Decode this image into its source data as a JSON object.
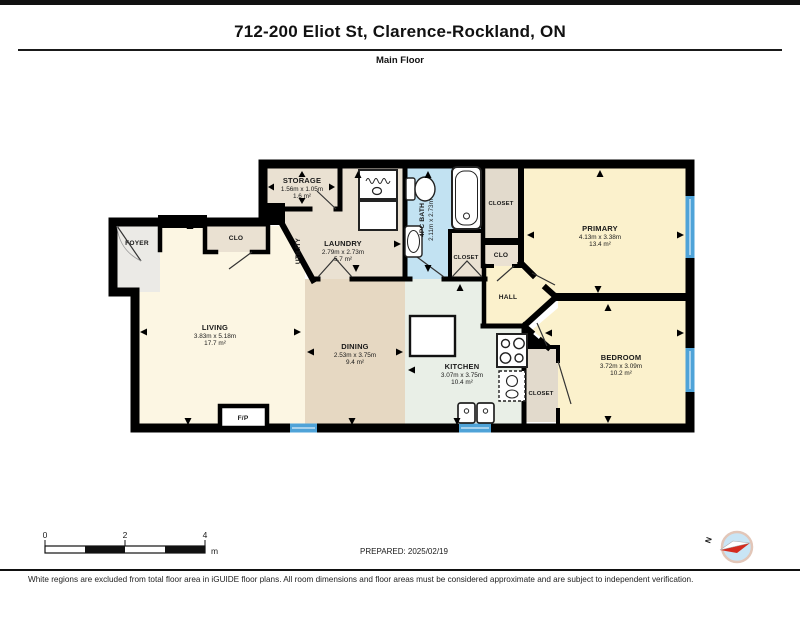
{
  "header": {
    "title": "712-200 Eliot St, Clarence-Rockland, ON",
    "subtitle": "Main Floor"
  },
  "rooms": {
    "storage": {
      "name": "STORAGE",
      "dims": "1.56m x 1.05m",
      "area": "1.6 m²"
    },
    "laundry": {
      "name": "LAUNDRY",
      "dims": "2.79m x 2.73m",
      "area": "5.7 m²"
    },
    "utility": {
      "name": "UTILITY"
    },
    "bath": {
      "name": "4PC BATH",
      "dims": "2.11m x 2.73m"
    },
    "living": {
      "name": "LIVING",
      "dims": "3.83m x 5.18m",
      "area": "17.7 m²"
    },
    "dining": {
      "name": "DINING",
      "dims": "2.53m x 3.75m",
      "area": "9.4 m²"
    },
    "kitchen": {
      "name": "KITCHEN",
      "dims": "3.07m x 3.75m",
      "area": "10.4 m²"
    },
    "primary": {
      "name": "PRIMARY",
      "dims": "4.13m x 3.38m",
      "area": "13.4 m²"
    },
    "bedroom": {
      "name": "BEDROOM",
      "dims": "3.72m x 3.09m",
      "area": "10.2 m²"
    },
    "hall": {
      "name": "HALL"
    },
    "foyer": {
      "name": "FOYER"
    },
    "clo_foyer": {
      "name": "CLO"
    },
    "closet_primary": {
      "name": "CLOSET"
    },
    "clo_hall": {
      "name": "CLO"
    },
    "closet_linen": {
      "name": "CLOSET"
    },
    "closet_bedroom": {
      "name": "CLOSET"
    },
    "fireplace": {
      "name": "F/P"
    }
  },
  "scale_bar": {
    "tick_start": "0",
    "tick_mid": "2",
    "tick_end": "4",
    "unit": "m"
  },
  "prepared": "PREPARED: 2025/02/19",
  "compass": {
    "north": "N"
  },
  "footer": {
    "disclaimer": "White regions are excluded from total floor area in iGUIDE floor plans. All room dimensions and floor areas must be considered approximate and are subject to independent verification."
  },
  "colors": {
    "wall": "#000000",
    "living": "#FCF6E3",
    "dining": "#E6D8C2",
    "kitchen": "#E9EFE7",
    "bedroom_yellow": "#FBF1CC",
    "bath_blue": "#C2E2F2",
    "closet_beige": "#EAE1D2",
    "foyer_gray": "#EBEAE6",
    "window_blue": "#4FA3D8"
  }
}
